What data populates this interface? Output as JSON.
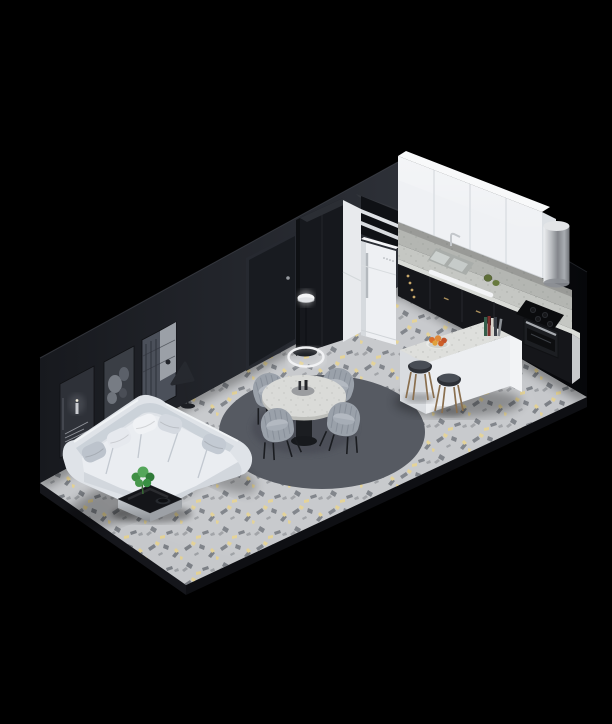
{
  "scene": {
    "style": "Isometric cutaway 3D render of a studio apartment at night on a black background",
    "areas": {
      "living": [
        "white corner sectional sofa with five cushions",
        "three monochrome posters on dark wall",
        "black floor lamp",
        "black coffee table with green plant and bowl"
      ],
      "dining": [
        "round marble dining table on black pedestal",
        "four gray ribbed tub chairs",
        "dark round rug",
        "white ring pendant light",
        "white globe floor lamp",
        "dark interior door"
      ],
      "kitchen": [
        "white upper cabinets",
        "terrazzo backsplash and countertop",
        "black lower cabinets with brass knobs",
        "double sink with chrome faucet",
        "white towel rail",
        "stainless cylindrical extractor hood",
        "black cooktop",
        "built-in oven",
        "tall black cabinet with open shelves",
        "white pantry column",
        "white retro fridge",
        "white kitchen island with marble top",
        "two bar stools with wooden legs",
        "stack of books",
        "bowl of orange fruit",
        "two avocados"
      ]
    },
    "floor": "light gray terrazzo with charcoal and gold flecks"
  },
  "colors": {
    "bg": "#000000",
    "wallLeft": "#23262c",
    "wallRight": "#0b0c0f",
    "floor": "#c6c8cb",
    "fleckDark": "#74787e",
    "fleckGold": "#e6d28e",
    "rug": "#565a62",
    "sofa": "#dfe3e8",
    "cabinetWhite": "#eff1f4",
    "cabinetBlack": "#15161a",
    "marble": "#c5c7c3",
    "fridge": "#eef0f3",
    "tableTop": "#dadbd8",
    "chairGray": "#9aa1aa",
    "wood": "#8a6f4e",
    "brass": "#c9a86a",
    "plant": "#4c9b4f",
    "fruit": "#d96c2b",
    "chrome": "#c6c9cd"
  }
}
